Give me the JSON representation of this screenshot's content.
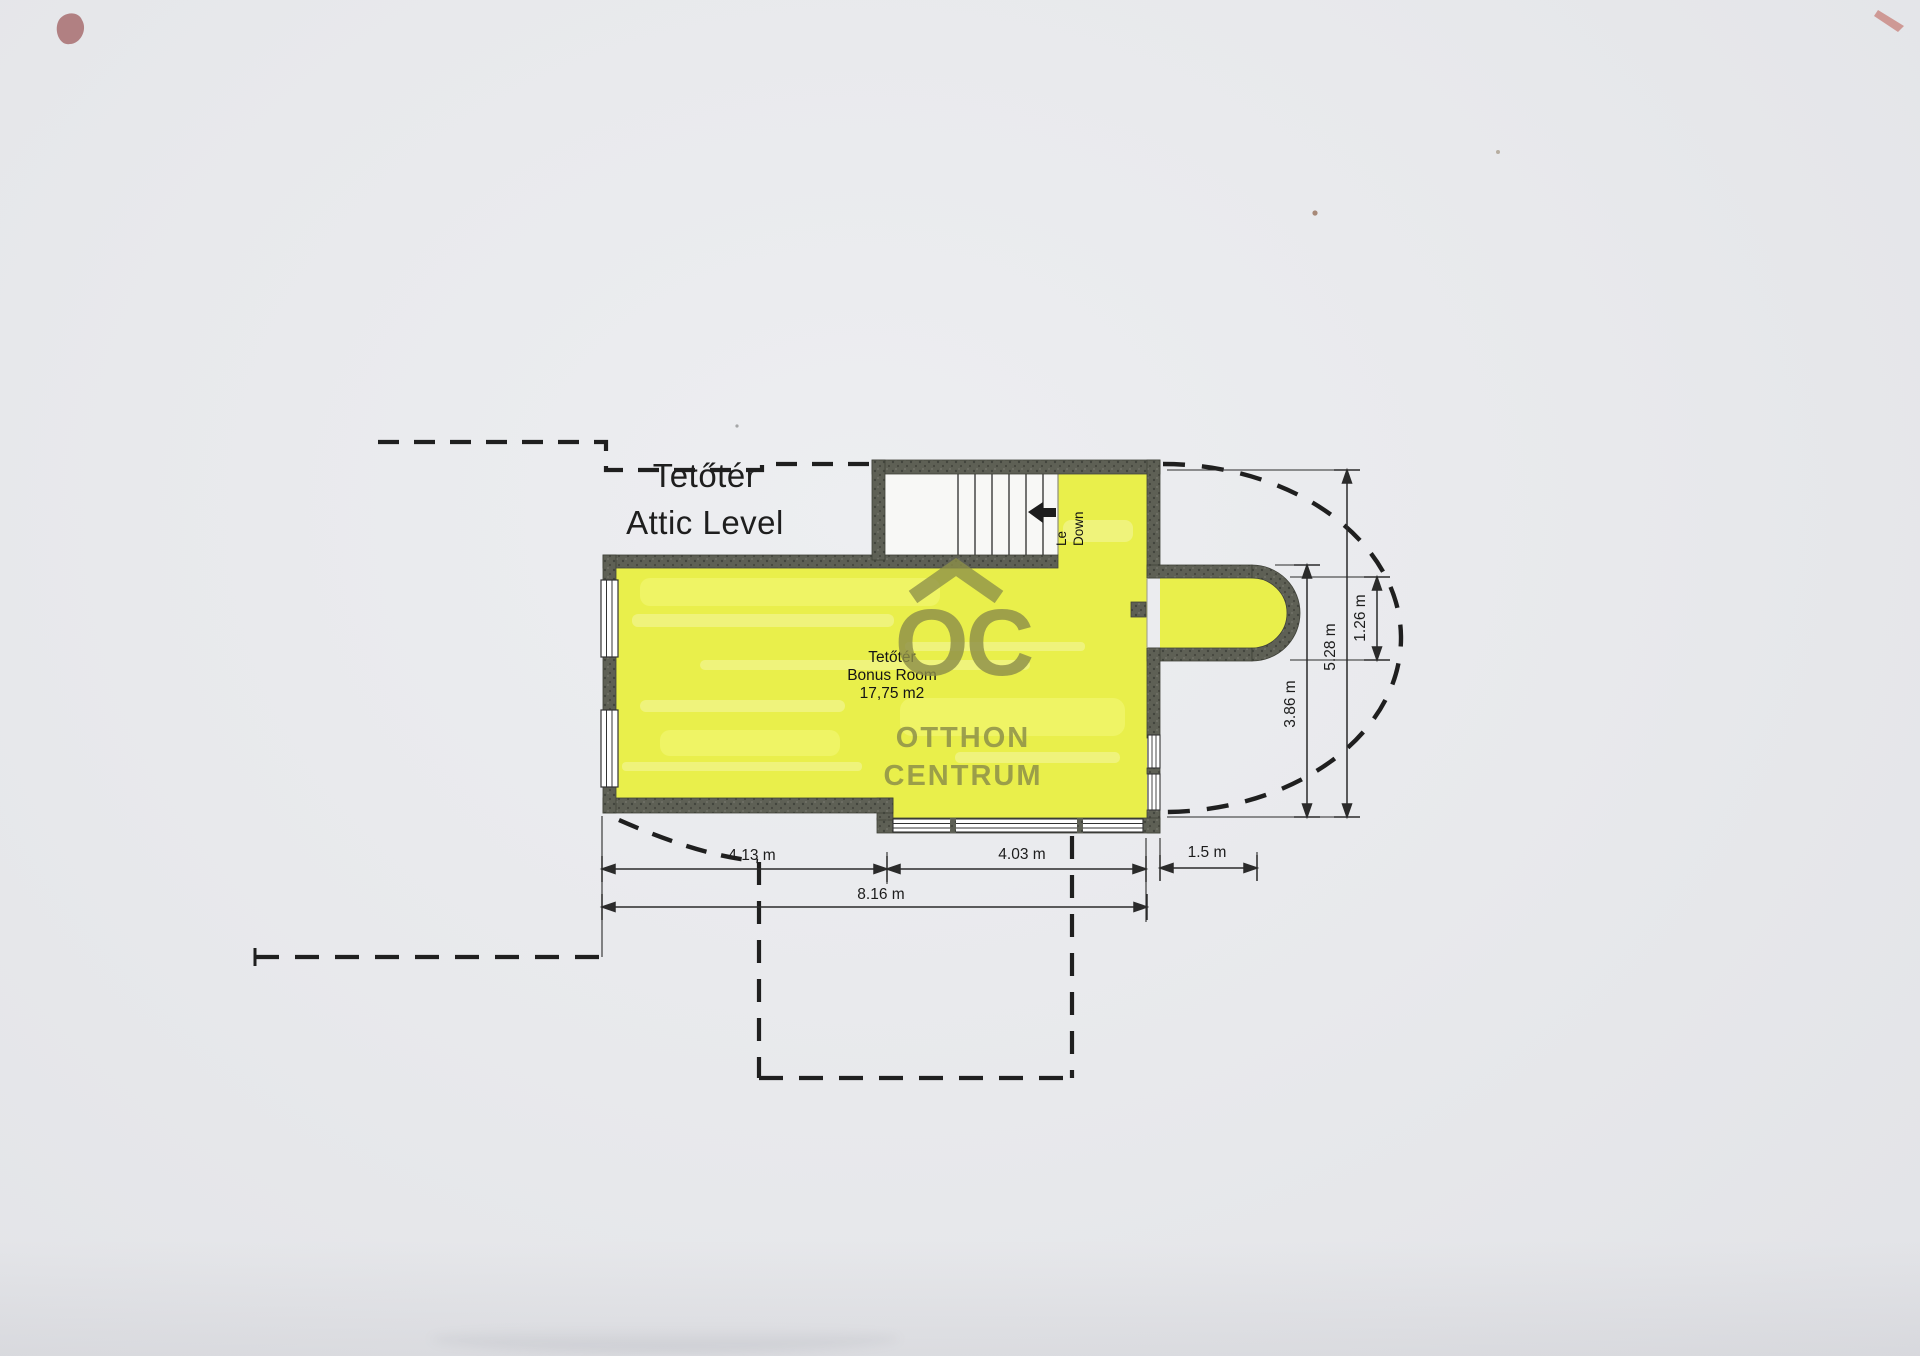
{
  "title": {
    "line1": "Tetőtér",
    "line2": "Attic Level"
  },
  "plan": {
    "room": {
      "label_line1": "Tetőtér",
      "label_line2": "Bonus Room",
      "label_line3": "17,75 m2"
    },
    "stairs": {
      "label_line1": "Le",
      "label_line2": "Down"
    }
  },
  "dimensions": {
    "width_left": "4.13 m",
    "width_right": "4.03 m",
    "width_total": "8.16 m",
    "bay_depth": "1.5 m",
    "height_inner": "3.86 m",
    "height_total": "5.28 m",
    "bay_height": "1.26 m"
  },
  "watermark": {
    "monogram": "OC",
    "line1": "OTTHON",
    "line2": "CENTRUM",
    "color": "#8d8f49"
  },
  "colors": {
    "background": "#e8e9ec",
    "room_fill": "#e9ef4b",
    "wall": "#5e6055",
    "line": "#1f1f1f",
    "stairwell": "#f8f8f6"
  }
}
